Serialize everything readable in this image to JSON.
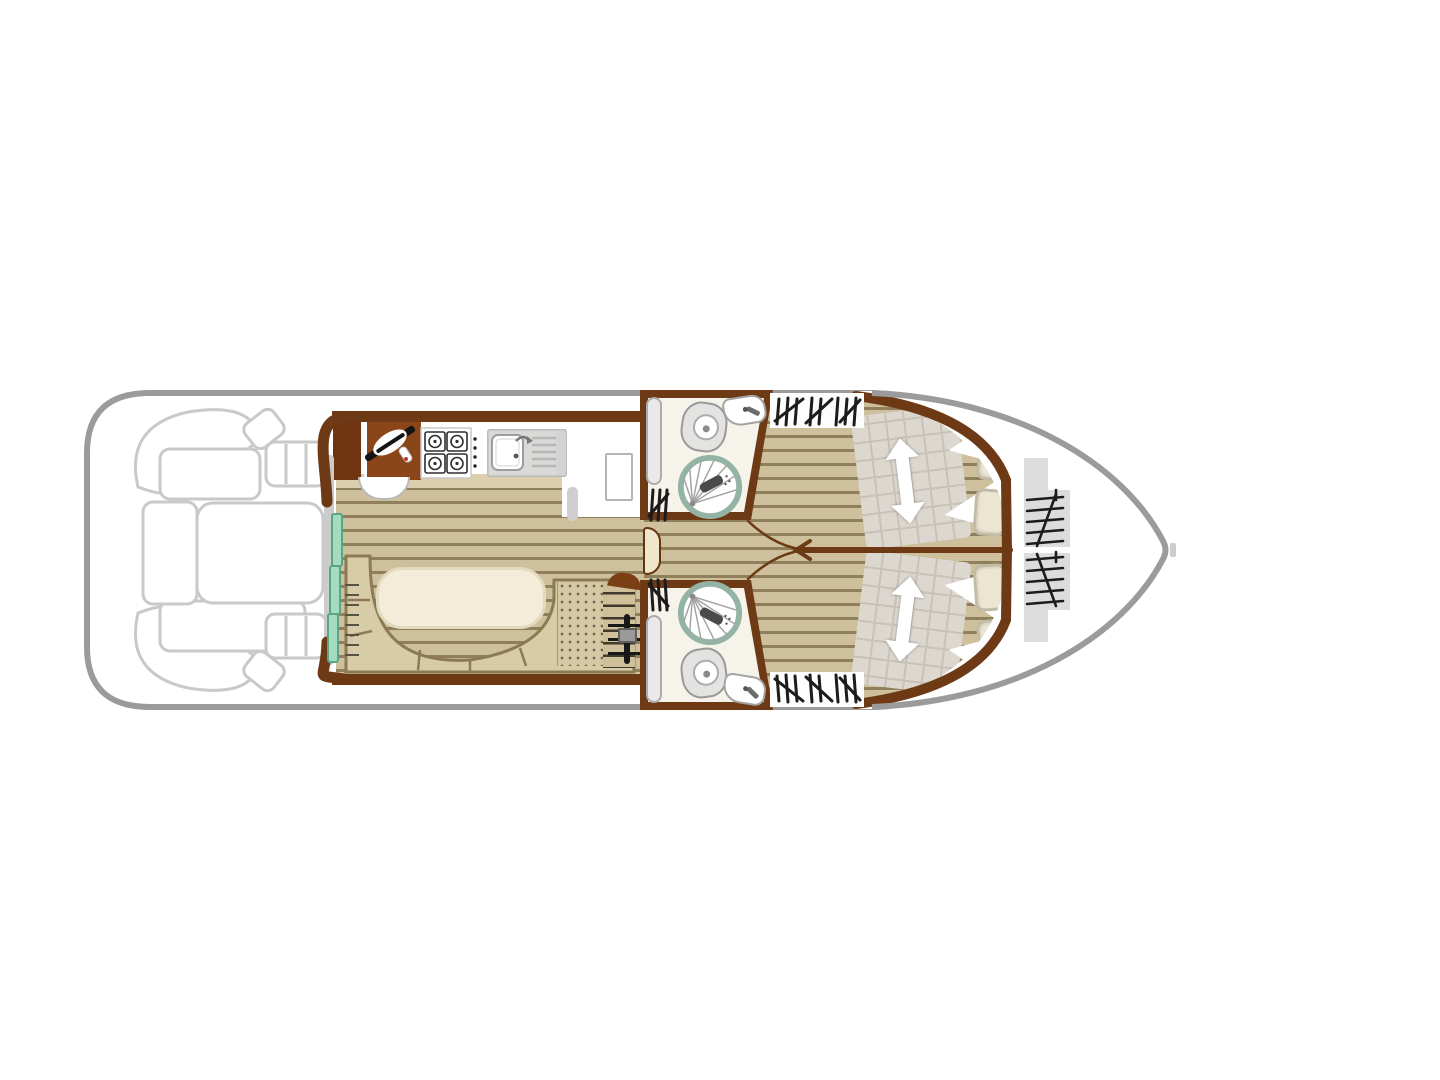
{
  "diagram": {
    "type": "houseboat-floor-plan",
    "label": "houseboat floor plan, top view"
  },
  "labels": {
    "stage": "houseboat floor plan",
    "stern_deck": "stern deck seating",
    "galley": "galley with helm station",
    "saloon": "saloon dinette",
    "entry_door": "sliding entry door",
    "bathroom_top": "bathroom upper",
    "bathroom_bottom": "bathroom lower",
    "corridor": "central corridor",
    "cabin_top": "bow cabin upper",
    "cabin_bottom": "bow cabin lower",
    "bow_steps": "bow access steps"
  },
  "icons": [
    "steering-wheel-icon",
    "helm-seat-icon",
    "cooktop-icon",
    "sink-icon",
    "fridge-icon",
    "toilet-icon",
    "washbasin-icon",
    "shower-icon",
    "wardrobe-hatch-icon",
    "ladder-icon",
    "bed-extension-arrow-icon",
    "pillow-icon",
    "sliding-door-icon",
    "companionway-steps-icon"
  ],
  "colors": {
    "hull": "#9b9b9b",
    "deck": "#c9c9c9",
    "wall": "#6d3a15",
    "counter-dark": "#6f3511",
    "counter-main": "#8a4619",
    "floor-base": "#cec09c",
    "floor-line": "#8f7f5a",
    "bench": "#d8cba8",
    "bench-edge": "#8b7a54",
    "table": "#f2ecd9",
    "table-edge": "#e3d9bf",
    "quilt": "#dcd7cf",
    "quilt-line": "#c8c2b8",
    "pillow": "#ece5d2",
    "pillow-edge": "#c2bba8",
    "teal": "#a5dcc0",
    "teal-edge": "#5aa585",
    "shower-ring": "#93b4a4",
    "glyph": "#1c1c1c",
    "step": "#dcdcdc",
    "bath-floor": "#f6f3ea",
    "cream-door": "#efe6cb"
  }
}
